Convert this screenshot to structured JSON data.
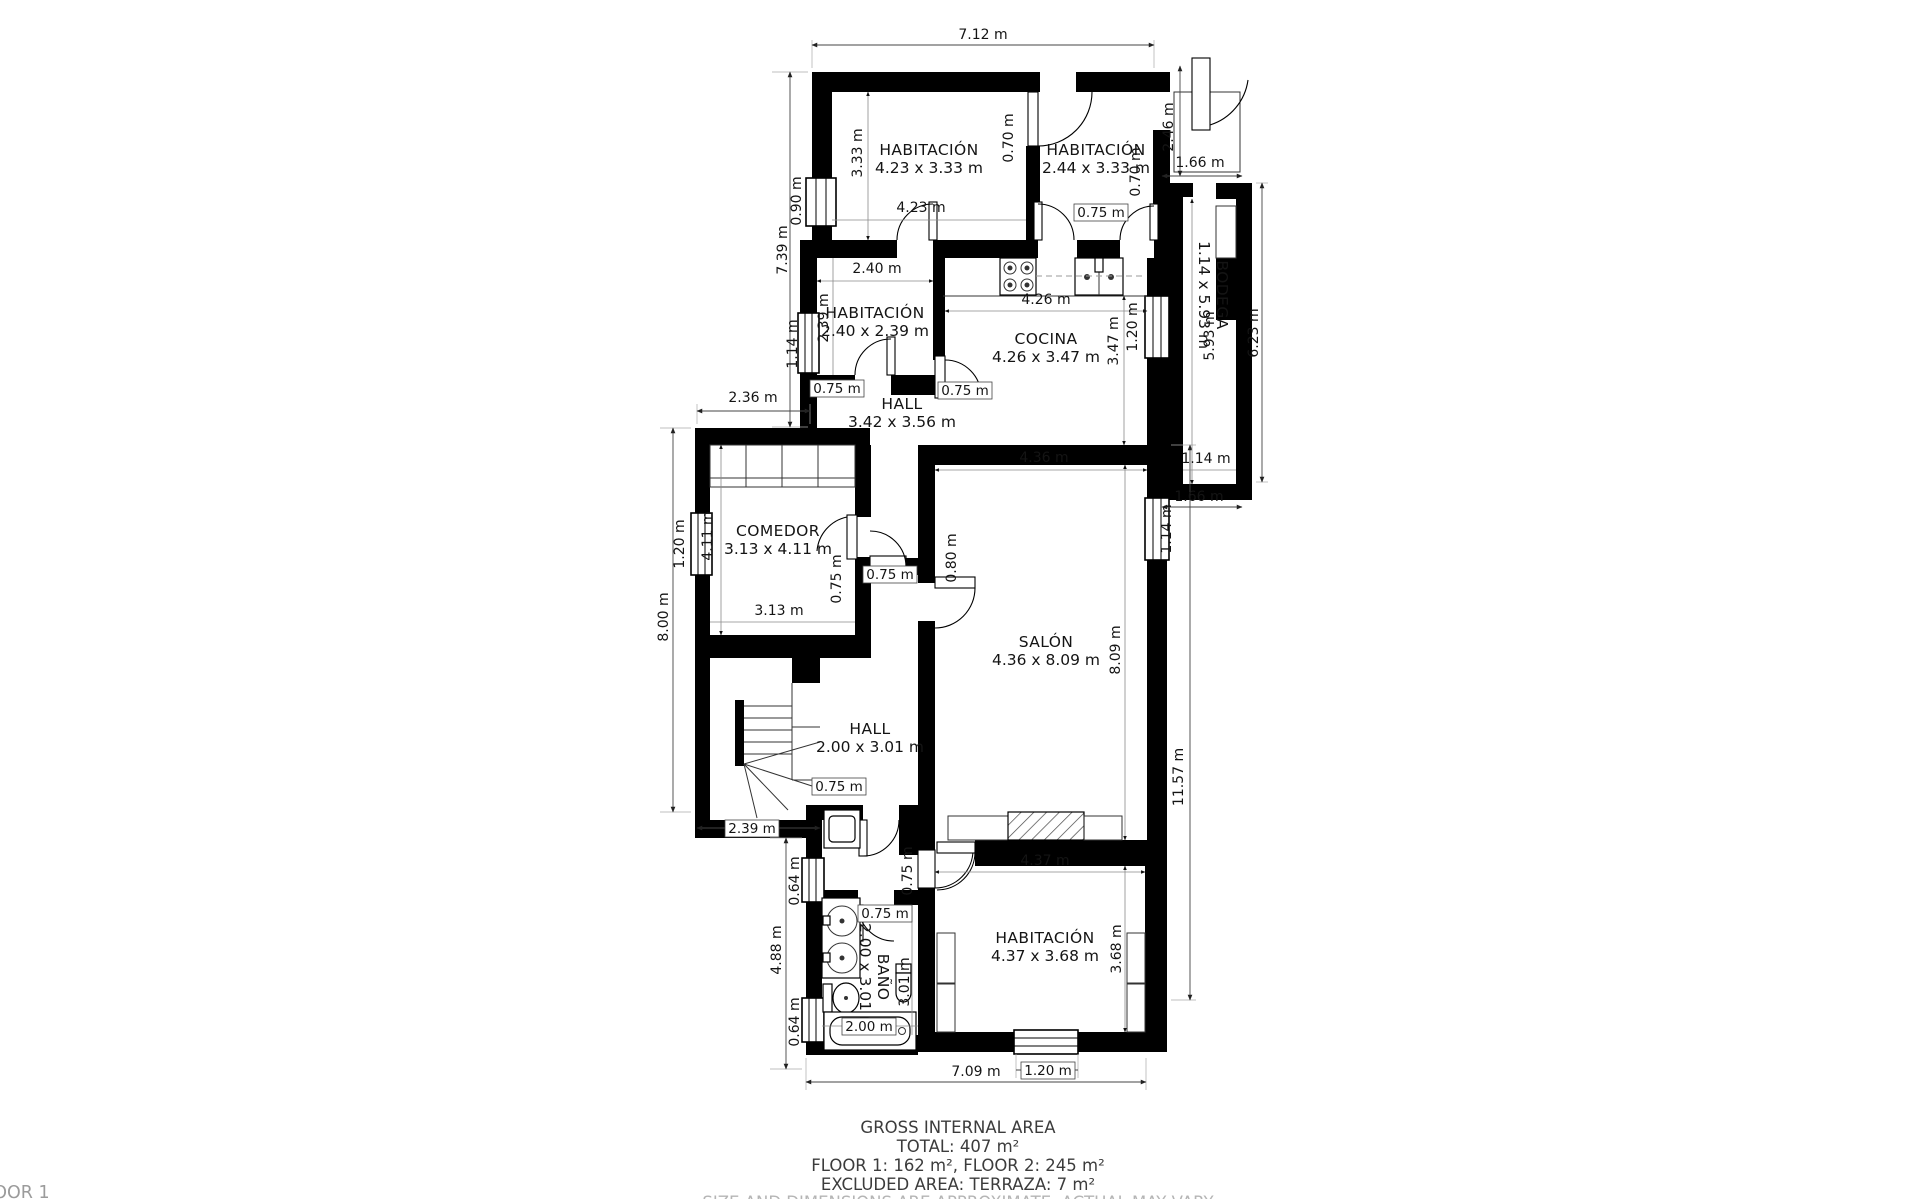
{
  "colors": {
    "wall": "#000000",
    "text": "#141414",
    "muted": "#b5b5b5"
  },
  "rooms": {
    "bed1": {
      "label": "HABITACIÓN",
      "size": "4.23 x 3.33 m"
    },
    "bed2": {
      "label": "HABITACIÓN",
      "size": "2.44 x 3.33 m"
    },
    "hab": {
      "label": "HABITACIÓN",
      "size": "2.40 x 2.39 m"
    },
    "cocina": {
      "label": "COCINA",
      "size": "4.26 x 3.47 m"
    },
    "hall_upper": {
      "label": "HALL",
      "size": "3.42 x 3.56 m"
    },
    "comedor": {
      "label": "COMEDOR",
      "size": "3.13 x 4.11 m"
    },
    "salon": {
      "label": "SALÓN",
      "size": "4.36 x 8.09 m"
    },
    "bodega": {
      "label": "BODEGA",
      "size": "1.14 x 5.93 m"
    },
    "hall_lower": {
      "label": "HALL",
      "size": "2.00 x 3.01 m"
    },
    "bano": {
      "label": "BAÑO",
      "size": "2.00 x 3.01 m"
    },
    "bed3": {
      "label": "HABITACIÓN",
      "size": "4.37 x 3.68 m"
    }
  },
  "dims": {
    "top_width": "7.12 m",
    "left_upper": "7.39 m",
    "bed1_window": "0.90 m",
    "bed1_h": "3.33 m",
    "bed1_w": "4.23 m",
    "bed_partition_door": "0.70 m",
    "bed2_right_door": "0.70 m",
    "bed2_door": "0.75 m",
    "terrace_h": "2.46 m",
    "terrace_w": "1.66 m",
    "bodega_len": "5.93 m",
    "right_upper_total": "6.23 m",
    "bodega_w": "1.14 m",
    "bodega_bottom": "1.66 m",
    "hab_w": "2.40 m",
    "hab_h": "2.39 m",
    "hab_window": "1.14 m",
    "hab_door": "0.75 m",
    "cocina_door": "0.75 m",
    "cocina_w": "4.26 m",
    "cocina_h": "3.47 m",
    "cocina_window": "1.20 m",
    "comedor_top": "2.36 m",
    "comedor_window": "1.20 m",
    "comedor_h": "4.11 m",
    "comedor_w": "3.13 m",
    "left_mid": "8.00 m",
    "comedor_door": "0.75 m",
    "salon_door": "0.80 m",
    "hall_upper_door": "0.75 m",
    "salon_w": "4.36 m",
    "salon_h": "8.09 m",
    "salon_window": "1.14 m",
    "right_lower_total": "11.57 m",
    "hall_lower_door": "0.75 m",
    "stairs_w": "2.39 m",
    "bano_window1": "0.64 m",
    "left_lower": "4.88 m",
    "bano_window2": "0.64 m",
    "corridor_door": "0.75 m",
    "bano_door": "0.75 m",
    "bano_w": "2.00 m",
    "bano_h": "3.01 m",
    "bed3_w": "4.37 m",
    "bed3_h": "3.68 m",
    "bed3_window": "1.20 m",
    "bottom_width": "7.09 m"
  },
  "summary": {
    "title": "GROSS INTERNAL AREA",
    "total": "TOTAL: 407 m²",
    "floors": "FLOOR 1: 162 m², FLOOR 2: 245 m²",
    "excluded": "EXCLUDED AREA: TERRAZA: 7 m²",
    "disclaimer": "SIZE AND DIMENSIONS ARE APPROXIMATE, ACTUAL MAY VARY",
    "floor_tag": "FLOOR 1"
  }
}
